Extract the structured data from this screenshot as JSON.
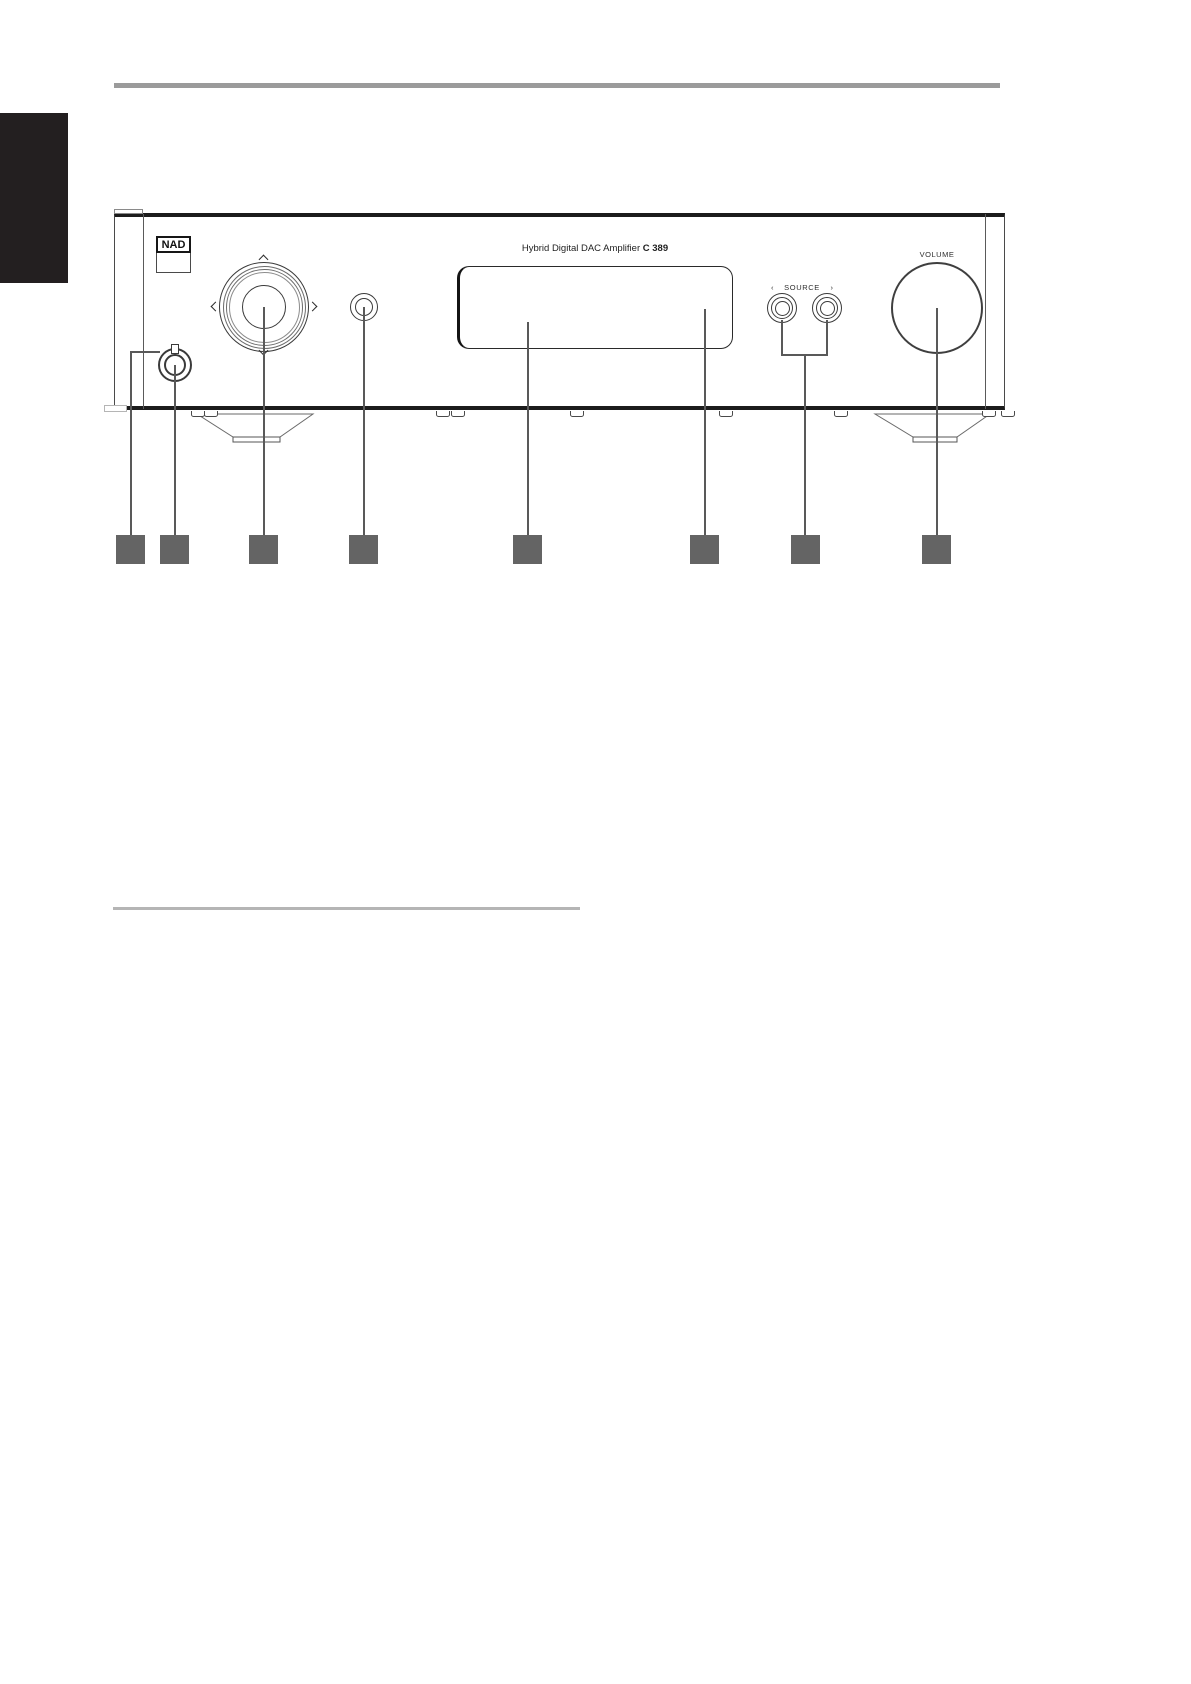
{
  "panel": {
    "brand_logo": "NAD",
    "model_title": {
      "regular": "Hybrid Digital DAC Amplifier",
      "bold": "C 389"
    },
    "labels": {
      "volume": "VOLUME",
      "source": "SOURCE"
    },
    "icons": {
      "source_prev": "‹",
      "source_next": "›"
    }
  },
  "colors": {
    "top_rule": "#9b9b9b",
    "side_tab": "#231f20",
    "callout_line": "#595959",
    "callout_box": "#646464",
    "divider": "#b5b5b5",
    "line_ink": "#3a3a3a"
  }
}
